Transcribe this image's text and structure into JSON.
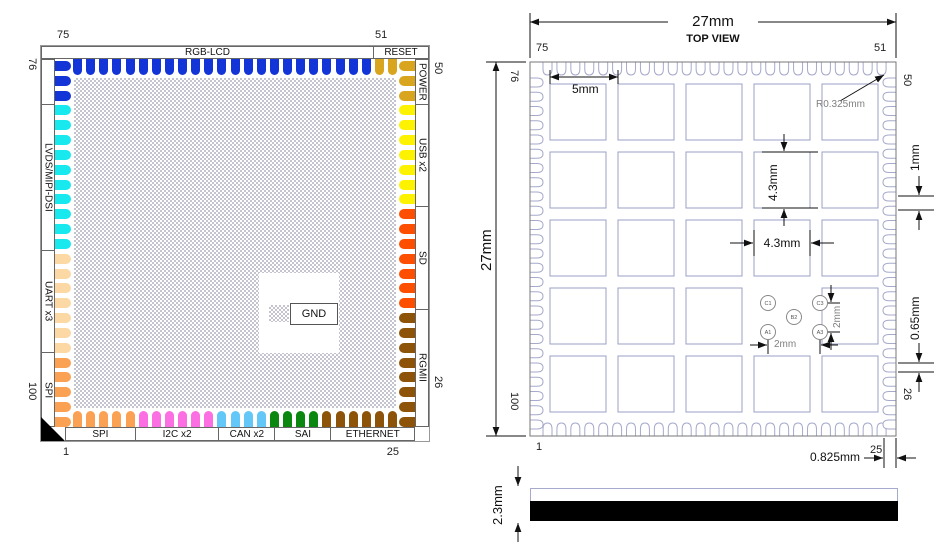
{
  "pinout": {
    "center_label": "GND",
    "numbers": {
      "top_left": "75",
      "top_right": "51",
      "bottom_left": "1",
      "bottom_right": "25",
      "left_top": "76",
      "left_bottom": "100",
      "right_top": "50",
      "right_bottom": "26"
    },
    "sides": {
      "top": [
        {
          "label": "RGB-LCD",
          "count": 23,
          "color": "#1334d6"
        },
        {
          "label": "RESET",
          "count": 2,
          "color": "#d9a51f"
        }
      ],
      "right": [
        {
          "label": "POWER",
          "count": 3,
          "color": "#d9a51f"
        },
        {
          "label": "USB x2",
          "count": 7,
          "color": "#fdf200"
        },
        {
          "label": "SD",
          "count": 7,
          "color": "#fe4f00"
        },
        {
          "label": "RGMII",
          "count": 8,
          "color": "#8d5409"
        }
      ],
      "bottom": [
        {
          "label": "SPI",
          "count": 5,
          "color": "#fba153"
        },
        {
          "label": "I2C x2",
          "count": 6,
          "color": "#fb6fe3"
        },
        {
          "label": "CAN x2",
          "count": 4,
          "color": "#63c7f7"
        },
        {
          "label": "SAI",
          "count": 4,
          "color": "#0a870f"
        },
        {
          "label": "ETHERNET",
          "count": 6,
          "color": "#8d5409"
        }
      ],
      "left": [
        {
          "label": "",
          "count": 3,
          "color": "#1334d6"
        },
        {
          "label": "LVDS/MIPI-DSI",
          "count": 10,
          "color": "#17e9ef"
        },
        {
          "label": "UART x3",
          "count": 7,
          "color": "#fcd9a4"
        },
        {
          "label": "SPI",
          "count": 5,
          "color": "#fba153"
        }
      ]
    }
  },
  "top_view": {
    "title": "TOP VIEW",
    "numbers": {
      "top_left": "75",
      "top_right": "51",
      "bottom_left": "1",
      "bottom_right": "25",
      "left_top": "76",
      "left_bottom": "100",
      "right_top": "50",
      "right_bottom": "26"
    },
    "dim_width": "27mm",
    "dim_height": "27mm",
    "dim_pitch": "5mm",
    "dim_pad_v": "4.3mm",
    "dim_pad_h": "4.3mm",
    "dim_pin_pitch": "1mm",
    "dim_pin_gap": "0.65mm",
    "dim_corner": "R0.325mm",
    "dim_edge": "0.825mm",
    "dim_fid_v": "2mm",
    "dim_fid_h": "2mm",
    "fiducials": [
      {
        "label": "C1"
      },
      {
        "label": "C3"
      },
      {
        "label": "B2"
      },
      {
        "label": "A1"
      },
      {
        "label": "A3"
      }
    ]
  },
  "side_view": {
    "dim_thickness": "2.3mm"
  }
}
